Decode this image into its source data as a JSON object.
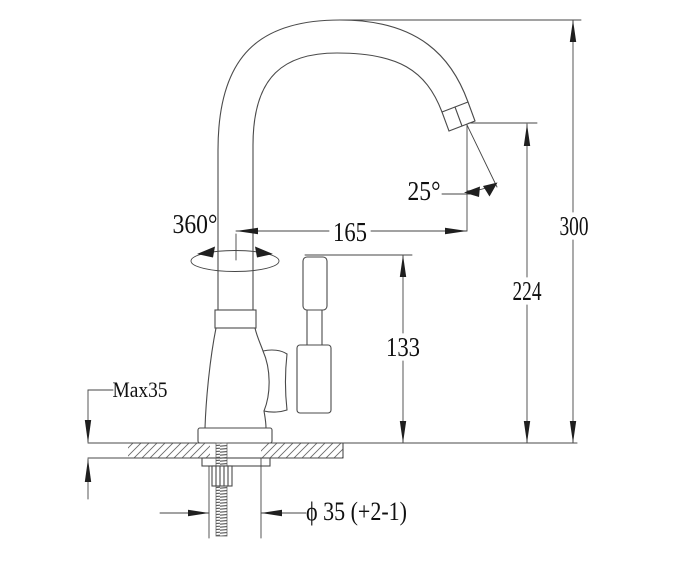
{
  "drawing": {
    "kind": "faucet-dimension-drawing",
    "colors": {
      "background": "#ffffff",
      "line": "#4a4a4a",
      "dimension_line": "#454545",
      "text": "#101010"
    },
    "labels": {
      "swivel": "360°",
      "spout_angle": "25°",
      "reach": "165",
      "spout_height": "224",
      "handle_height": "133",
      "overall_height": "300",
      "max_thickness": "Max35",
      "hole_diameter": "ϕ 35 (+2-1)"
    }
  }
}
